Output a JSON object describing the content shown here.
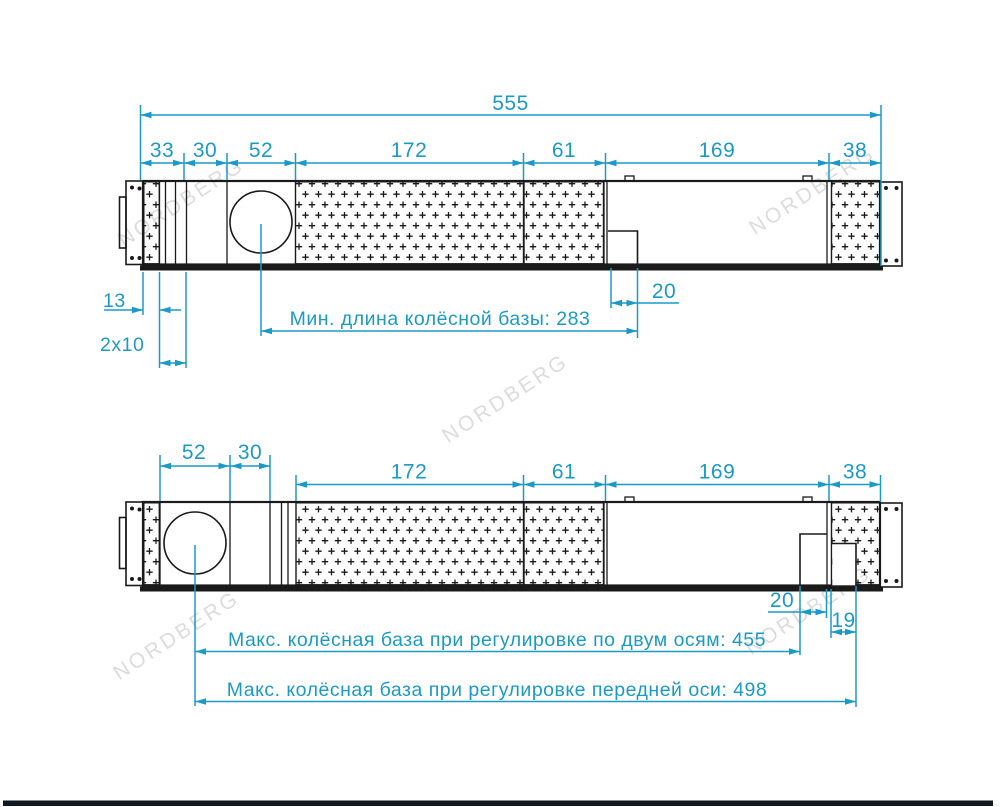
{
  "watermark": "NORDBERG",
  "colors": {
    "accent": "#1b9ac8",
    "line": "#1a1a1a",
    "watermark": "#d6d6d6",
    "footer": "#101820"
  },
  "top_view": {
    "total_length": "555",
    "segments": [
      "33",
      "30",
      "52",
      "172",
      "61",
      "169",
      "38"
    ],
    "edge_offset": "13",
    "slot_pair": "2x10",
    "plate_offset": "20",
    "min_wheelbase": "Мин. длина колёсной базы: 283"
  },
  "bottom_view": {
    "front_segments": [
      "52",
      "30"
    ],
    "segments": [
      "172",
      "61",
      "169",
      "38"
    ],
    "plate_offset": "20",
    "edge_offset": "19",
    "max_wheelbase_two_axes": "Макс. колёсная база при регулировке по двум осям: 455",
    "max_wheelbase_front_axis": "Макс. колёсная база при регулировке передней оси: 498"
  }
}
